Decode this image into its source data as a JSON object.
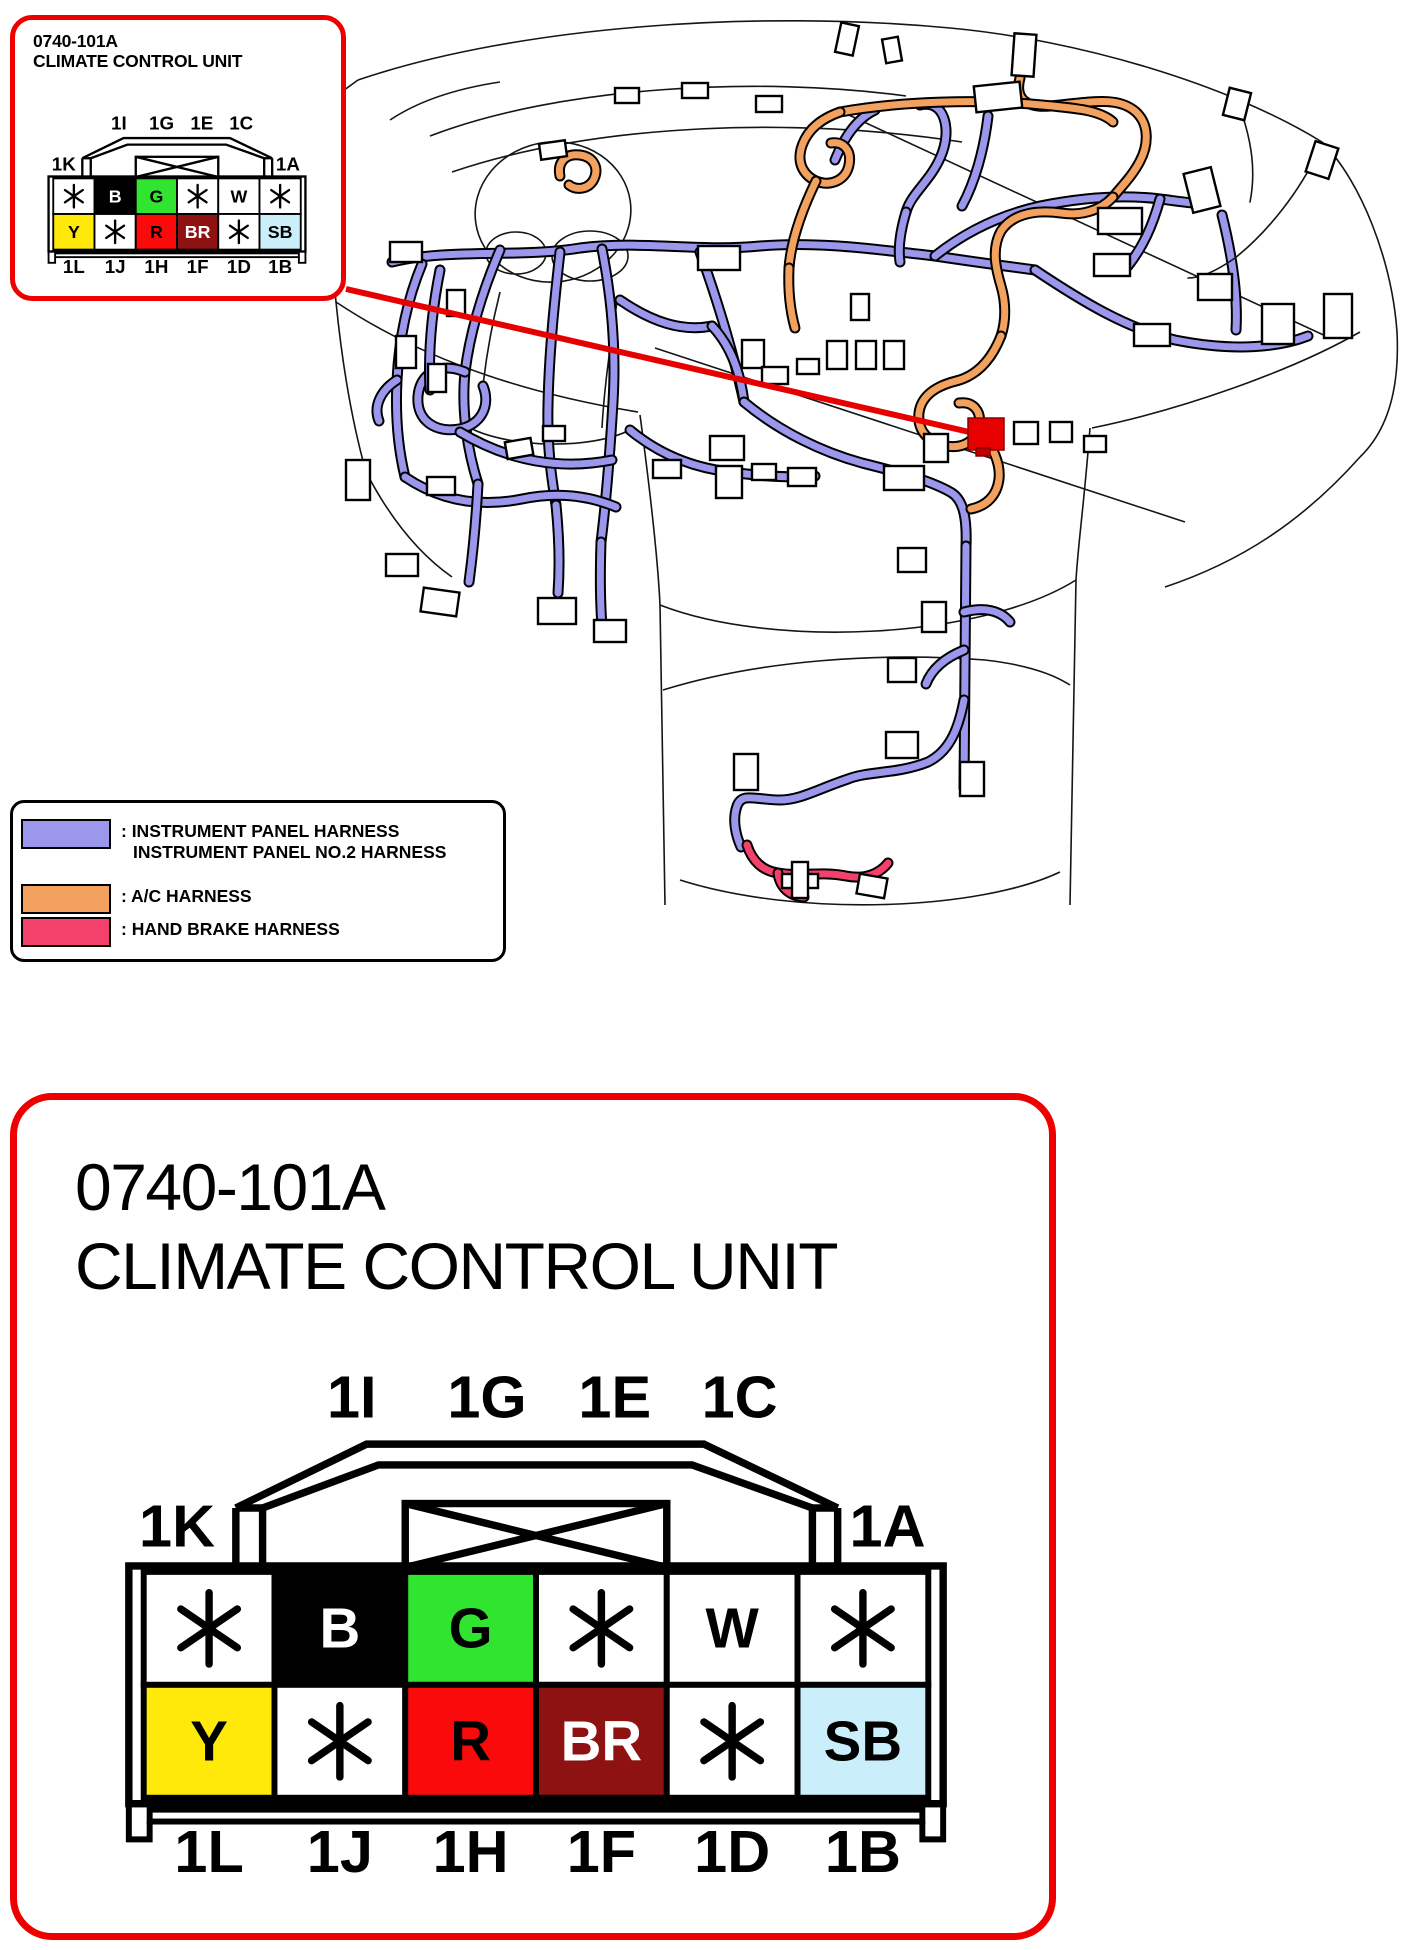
{
  "colors": {
    "frame_red": "#EE0000",
    "leader_red": "#E60000",
    "marker_red": "#E60000",
    "instrument_panel_harness": "#9A97EC",
    "ac_harness": "#F2A15E",
    "hand_brake_harness": "#F2416B"
  },
  "callout": {
    "code": "0740-101A",
    "name": "CLIMATE CONTROL UNIT"
  },
  "detail_panel": {
    "code": "0740-101A",
    "name": "CLIMATE CONTROL UNIT"
  },
  "legend": {
    "entries": [
      {
        "color": "#9A97EC",
        "label": ": INSTRUMENT PANEL HARNESS",
        "label_line2": "INSTRUMENT PANEL NO.2 HARNESS"
      },
      {
        "color": "#F2A15E",
        "label": ": A/C HARNESS",
        "label_line2": ""
      },
      {
        "color": "#F2416B",
        "label": ": HAND BRAKE HARNESS",
        "label_line2": ""
      }
    ]
  },
  "connector": {
    "top_labels": [
      "1I",
      "1G",
      "1E",
      "1C"
    ],
    "left_label": "1K",
    "right_label": "1A",
    "bottom_labels": [
      "1L",
      "1J",
      "1H",
      "1F",
      "1D",
      "1B"
    ],
    "rows": [
      [
        {
          "pin": "*",
          "bg": "#FFFFFF",
          "fg": "#000000"
        },
        {
          "pin": "B",
          "bg": "#000000",
          "fg": "#FFFFFF"
        },
        {
          "pin": "G",
          "bg": "#30E430",
          "fg": "#000000"
        },
        {
          "pin": "*",
          "bg": "#FFFFFF",
          "fg": "#000000"
        },
        {
          "pin": "W",
          "bg": "#FFFFFF",
          "fg": "#000000"
        },
        {
          "pin": "*",
          "bg": "#FFFFFF",
          "fg": "#000000"
        }
      ],
      [
        {
          "pin": "Y",
          "bg": "#FFE90A",
          "fg": "#000000"
        },
        {
          "pin": "*",
          "bg": "#FFFFFF",
          "fg": "#000000"
        },
        {
          "pin": "R",
          "bg": "#FA0A0A",
          "fg": "#000000"
        },
        {
          "pin": "BR",
          "bg": "#8E1212",
          "fg": "#FFFFFF"
        },
        {
          "pin": "*",
          "bg": "#FFFFFF",
          "fg": "#000000"
        },
        {
          "pin": "SB",
          "bg": "#CBEFFA",
          "fg": "#000000"
        }
      ]
    ]
  }
}
